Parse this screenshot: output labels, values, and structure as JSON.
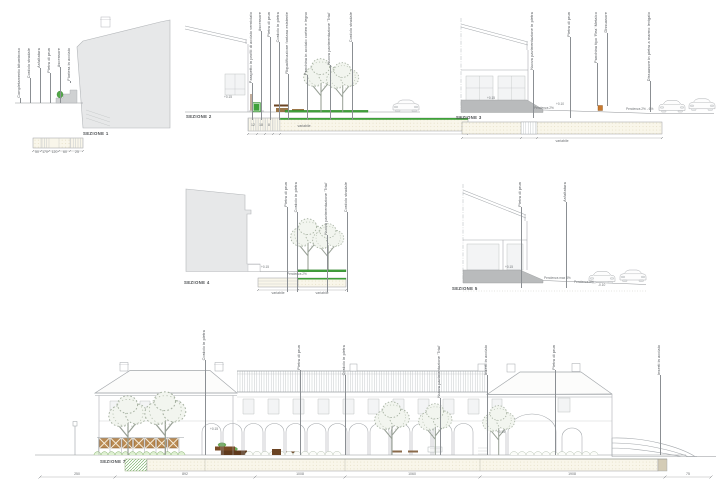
{
  "colors": {
    "green": "#3fa03a",
    "green_dark": "#26761f",
    "brown": "#6b4423",
    "tan": "#b98a52",
    "orange": "#c8792e",
    "grayfill": "#b9bbbc",
    "beige": "#f9f6ea",
    "textgray": "#4a4a4a"
  },
  "s1": {
    "title": "SEZIONE 1",
    "labels": [
      "Completamento bituminoso",
      "Cordolo stradale",
      "Asfaltatura",
      "Pietra di prun",
      "Ascensore",
      "Fioriera in acciaio"
    ],
    "dims": [
      "50",
      "170",
      "120",
      "60",
      "25"
    ]
  },
  "s2": {
    "title": "SEZIONE 2",
    "labels": [
      "Parapetto in profili di acciaio verniciato",
      "Ascensore",
      "Pietra di prun",
      "Cordolo in pietra",
      "Riqualificazione fontana esistente",
      "Panchina in acciaio corten e legno",
      "Nuova pavimentazione 'Trial'",
      "Cordolo stradale"
    ],
    "dims_small": [
      "12",
      "18",
      "8"
    ],
    "dim_span": "variabile",
    "spot": "+0.15"
  },
  "s3": {
    "title": "SEZIONE 3",
    "labels": [
      "Nuova pavimentazione in pietra",
      "Pietra di prun",
      "Panchina tipo 'Rea' Metalco",
      "Dissuasore",
      "Dissuasore in pietra a marmo levigato"
    ],
    "pendenza": [
      "Pendenza 2%",
      "Pendenza 2% - 6%"
    ],
    "spots": [
      "+0.15",
      "+0.10"
    ],
    "dim_span": "variabile"
  },
  "s4": {
    "title": "SEZIONE 4",
    "labels": [
      "Pietra di prun",
      "Cordolo in pietra",
      "Nuova pavimentazione 'Trial'",
      "Cordolo stradale"
    ],
    "pendenza": "Pendenza 2%",
    "spot": "+0.15",
    "dims": [
      "variabile",
      "variabile"
    ]
  },
  "s5": {
    "title": "SEZIONE 5",
    "labels": [
      "Pietra di prun",
      "Asfaltatura"
    ],
    "pendenza": [
      "Pendenza max 8%",
      "Pendenza 2%"
    ],
    "spots": [
      "+0.15",
      "-0.10"
    ]
  },
  "s7": {
    "title": "SEZIONE 7",
    "labels": [
      "Cordolo in pietra",
      "Pietra di prun",
      "Cordolo in pietra",
      "Nuova pavimentazione 'Trial'",
      "Inserti in acciaio",
      "Pietra di prun",
      "Inserti in acciaio"
    ],
    "dims": [
      "250",
      "892",
      "1008",
      "1060",
      "1908",
      "75"
    ],
    "spots": [
      "+0.15",
      "+0.15"
    ]
  }
}
